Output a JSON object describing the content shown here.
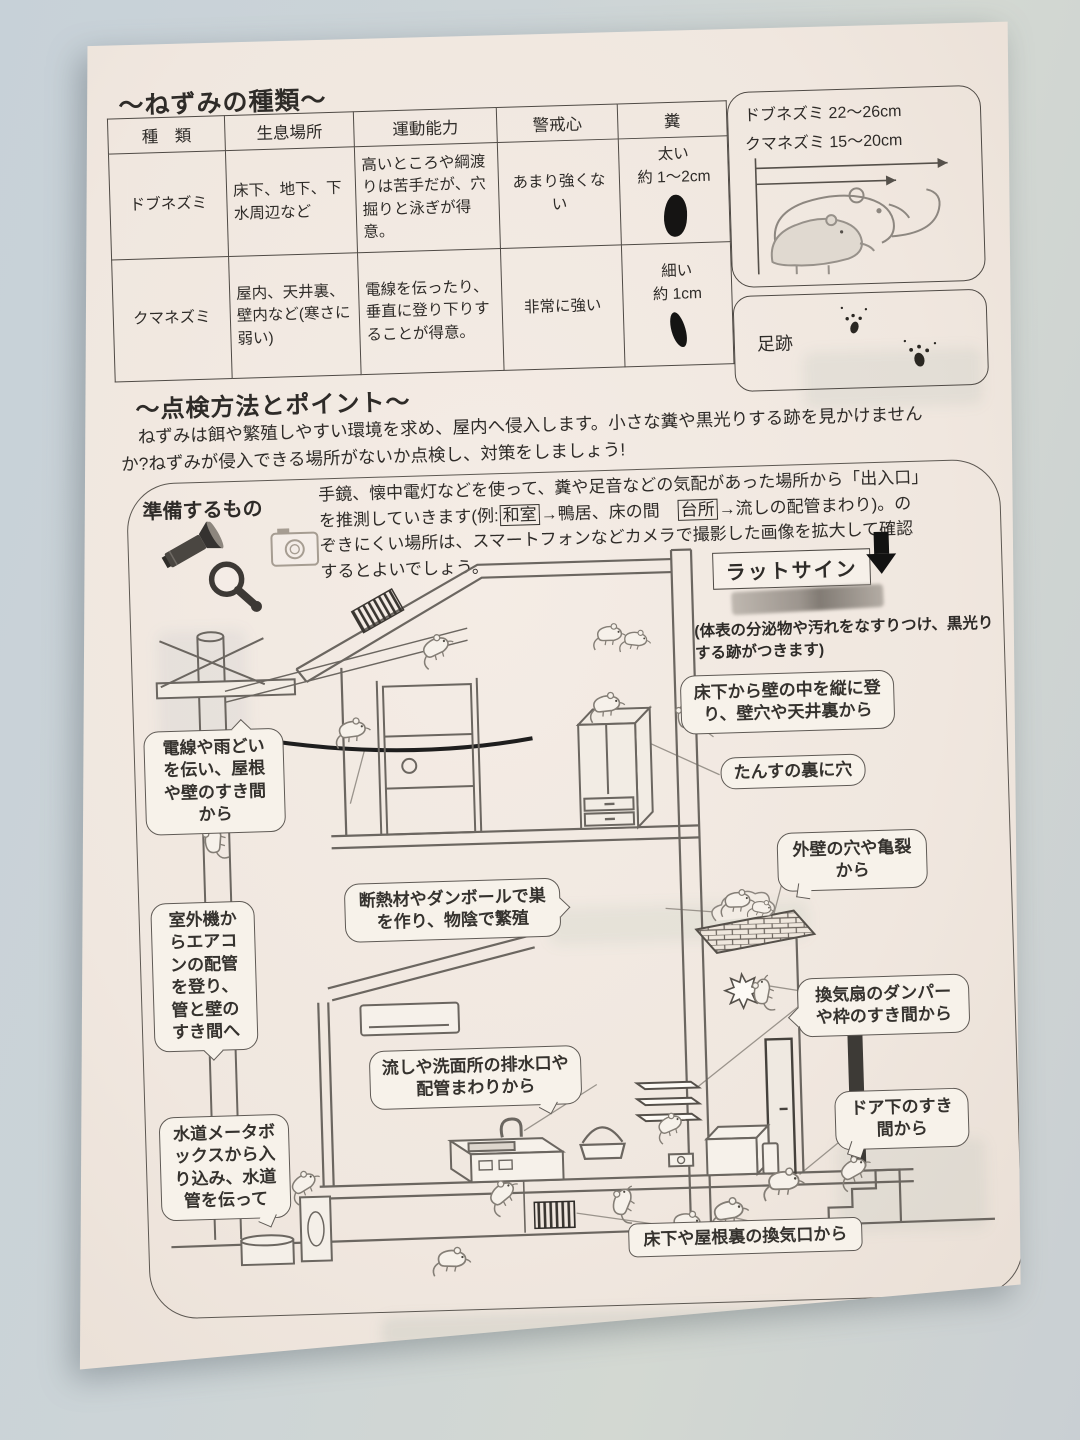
{
  "colors": {
    "background": "#ccd4d7",
    "paper": "#f0e7df",
    "ink": "#2e2b28",
    "droppings": "#151413"
  },
  "icons": {
    "prepare_tools": [
      "flashlight-icon",
      "magnifying-glass-icon",
      "camera-icon"
    ],
    "rat_sign_pointer": "arrow-down-icon"
  },
  "paper": {
    "section1": {
      "title": "〜ねずみの種類〜",
      "table": {
        "headers": {
          "type": "種　類",
          "habitat": "生息場所",
          "ability": "運動能力",
          "wariness": "警戒心",
          "droppings": "糞"
        },
        "rows": [
          {
            "type": "ドブネズミ",
            "habitat": "床下、地下、下水周辺など",
            "ability": "高いところや綱渡りは苦手だが、穴掘りと泳ぎが得意。",
            "wariness": "あまり強くない",
            "droppings_size": "太い",
            "droppings_length": "約 1〜2cm"
          },
          {
            "type": "クマネズミ",
            "habitat": "屋内、天井裏、壁内など(寒さに弱い)",
            "ability": "電線を伝ったり、垂直に登り下りすることが得意。",
            "wariness": "非常に強い",
            "droppings_size": "細い",
            "droppings_length": "約 1cm"
          }
        ]
      },
      "size_box": {
        "dobu": "ドブネズミ 22〜26cm",
        "kuma": "クマネズミ 15〜20cm"
      },
      "footprints_label": "足跡"
    },
    "section2": {
      "title": "〜点検方法とポイント〜",
      "intro": "ねずみは餌や繁殖しやすい環境を求め、屋内へ侵入します。小さな糞や黒光りする跡を見かけませんか?ねずみが侵入できる場所がないか点検し、対策をしましょう!",
      "prepare_label": "準備するもの",
      "method": {
        "part1": "手鏡、懐中電灯などを使って、糞や足音などの気配があった場所から「出入口」を推測していきます(例:",
        "boxed1": "和室",
        "part2": "→鴨居、床の間　",
        "boxed2": "台所",
        "part3": "→流しの配管まわり)。のぞきにくい場所は、スマートフォンなどカメラで撮影した画像を拡大して確認するとよいでしょう。"
      },
      "rat_sign": {
        "label": "ラットサイン",
        "note": "(体表の分泌物や汚れをなすりつけ、黒光りする跡がつきます)"
      },
      "callouts": [
        {
          "text": "電線や雨どいを伝い、屋根や壁のすき間から"
        },
        {
          "text": "室外機からエアコンの配管を登り、管と壁のすき間へ"
        },
        {
          "text": "水道メータボックスから入り込み、水道管を伝って"
        },
        {
          "text": "床下から壁の中を縦に登り、壁穴や天井裏から"
        },
        {
          "text": "たんすの裏に穴"
        },
        {
          "text": "外壁の穴や亀裂から"
        },
        {
          "text": "換気扇のダンパーや枠のすき間から"
        },
        {
          "text": "ドア下のすき間から"
        },
        {
          "text": "断熱材やダンボールで巣を作り、物陰で繁殖"
        },
        {
          "text": "流しや洗面所の排水口や配管まわりから"
        },
        {
          "text": "床下や屋根裏の換気口から"
        }
      ]
    }
  }
}
